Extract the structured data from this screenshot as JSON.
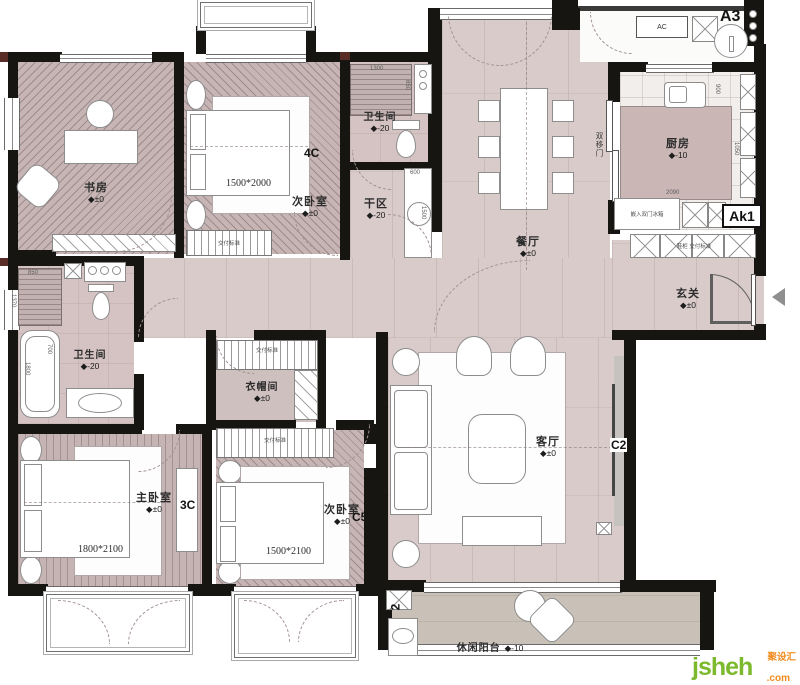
{
  "rooms": {
    "study": {
      "name": "书房",
      "level": "◆±0"
    },
    "bedroom_a": {
      "name": "次卧室",
      "level": "◆±0",
      "bed": "1500*2000"
    },
    "bath_a": {
      "name": "卫生间",
      "level": "◆-20"
    },
    "dry_area": {
      "name": "干区",
      "level": "◆-20"
    },
    "dining": {
      "name": "餐厅",
      "level": "◆±0"
    },
    "kitchen": {
      "name": "厨房",
      "level": "◆-10"
    },
    "entry": {
      "name": "玄关",
      "level": "◆±0"
    },
    "living": {
      "name": "客厅",
      "level": "◆±0"
    },
    "master_bath": {
      "name": "卫生间",
      "level": "◆-20"
    },
    "master_bedroom": {
      "name": "主卧室",
      "level": "◆±0",
      "bed": "1800*2100"
    },
    "cloakroom": {
      "name": "衣帽间",
      "level": "◆±0"
    },
    "bedroom_b": {
      "name": "次卧室",
      "level": "◆±0",
      "bed": "1500*2100"
    },
    "balcony": {
      "name": "休闲阳台",
      "level": "◆-10"
    }
  },
  "markers": {
    "a3": "A3",
    "ak1": "Ak1",
    "ac": "AC",
    "c4": "4C",
    "c3": "3C",
    "c2": "C2",
    "c5": "C5",
    "a2": "2"
  },
  "annotations": {
    "double_sliding_door": "双移门",
    "fridge": "嵌入双门冰箱",
    "shoe_cabinet": "鞋柜 交付标准",
    "wardrobe_note": "交付标准"
  },
  "dimensions": {
    "d1300": "1300",
    "d850": "850",
    "d900": "900",
    "d600": "600",
    "d1500": "1500",
    "d2090": "2090",
    "d1050": "1050",
    "d1370": "1370",
    "d1800": "1800",
    "d700": "700"
  },
  "colors": {
    "wall": "#171512",
    "floor": "#d8cbca",
    "bedroom_floor": "#c7b5b5",
    "counter": "#c9b6b5",
    "balcony": "#c9c1b8",
    "logo_green": "#7cb92c",
    "logo_orange": "#f28b1e"
  },
  "logo": {
    "brand": "jsheh",
    "tld": ".com",
    "cn": "聚设汇"
  }
}
